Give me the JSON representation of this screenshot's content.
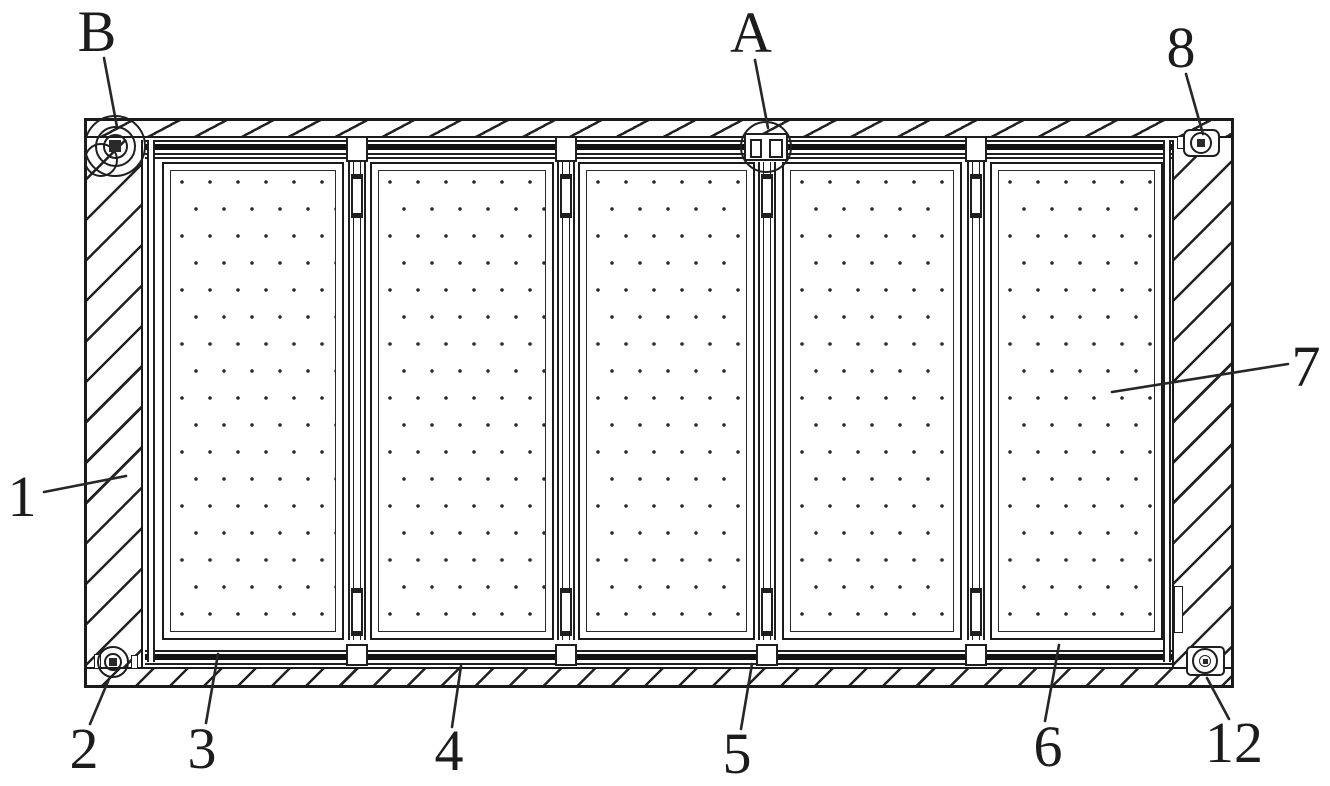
{
  "figure": {
    "kind": "patent technical line drawing",
    "description": "Top view of a rectangular frame assembly with hatched borders enclosing five dotted infill panels separated by four vertical divider bars; fasteners at the corners and circled detail callouts at the top-left (B) and top-center (A).",
    "background_color": "#ffffff",
    "line_color": "#1f1f1f"
  },
  "structure": {
    "panel_count": 5,
    "divider_count": 4,
    "detail_circle_labels": [
      "B",
      "A"
    ]
  },
  "reference_labels": [
    {
      "id": "B",
      "text": "B",
      "target": "top-left corner fastener detail circle"
    },
    {
      "id": "A",
      "text": "A",
      "target": "top-center divider joint detail circle"
    },
    {
      "id": "8",
      "text": "8",
      "target": "top-right corner fastener"
    },
    {
      "id": "1",
      "text": "1",
      "target": "left hatched frame border"
    },
    {
      "id": "7",
      "text": "7",
      "target": "right-most dotted panel"
    },
    {
      "id": "2",
      "text": "2",
      "target": "bottom-left corner fastener"
    },
    {
      "id": "3",
      "text": "3",
      "target": "bottom rail below panel 1"
    },
    {
      "id": "4",
      "text": "4",
      "target": "bottom rail below panel 2"
    },
    {
      "id": "5",
      "text": "5",
      "target": "bottom-center divider joint"
    },
    {
      "id": "6",
      "text": "6",
      "target": "bottom rail below panel 5"
    },
    {
      "id": "12",
      "text": "12",
      "target": "bottom-right corner fastener"
    }
  ]
}
